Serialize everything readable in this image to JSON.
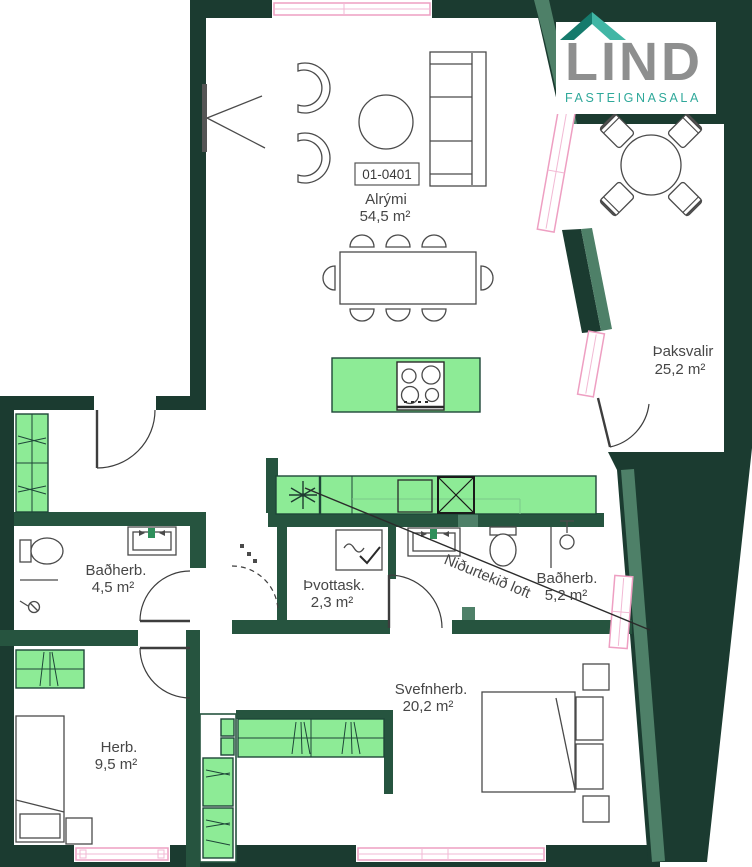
{
  "branding": {
    "logo_text": "LIND",
    "logo_subtitle": "FASTEIGNASALA",
    "logo_colors": {
      "text": "#8E8F8F",
      "subtitle": "#2FA89A",
      "roof_dark": "#157A6C",
      "roof_light": "#41B6A5"
    }
  },
  "unit_label": "01-0401",
  "rooms": [
    {
      "id": "alrymi",
      "name": "Alrými",
      "area": "54,5 m²"
    },
    {
      "id": "thaksvalir",
      "name": "Þaksvalir",
      "area": "25,2 m²"
    },
    {
      "id": "badherb1",
      "name": "Baðherb.",
      "area": "4,5 m²"
    },
    {
      "id": "thvottask",
      "name": "Þvottask.",
      "area": "2,3 m²"
    },
    {
      "id": "badherb2",
      "name": "Baðherb.",
      "area": "5,2 m²"
    },
    {
      "id": "svefnherb",
      "name": "Svefnherb.",
      "area": "20,2 m²"
    },
    {
      "id": "herb",
      "name": "Herb.",
      "area": "9,5 m²"
    }
  ],
  "annotations": {
    "lowered_ceiling": "Niðurtekið loft"
  },
  "palette": {
    "wall_dark": "#1B3B30",
    "wall_partition": "#26543F",
    "wall_accent": "#4E8068",
    "cabinet_green": "#8DEB96",
    "window_pink": "#EE9FC2",
    "furniture_line": "#4A4A4A",
    "label_text": "#464646"
  }
}
